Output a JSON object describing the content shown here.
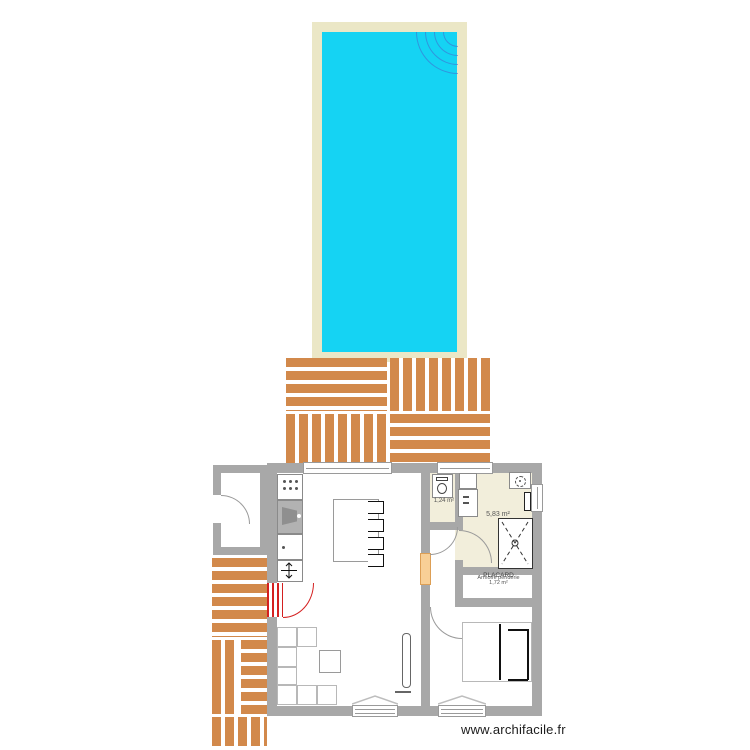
{
  "page": {
    "watermark": "www.archifacile.fr"
  },
  "rooms": {
    "wc": {
      "area_label": "1,24 m²"
    },
    "bathroom": {
      "area_label": "5,83 m²"
    },
    "placard": {
      "name": "PLACARD",
      "furniture_label": "Armoire penderie",
      "area_label": "1,72 m²"
    }
  },
  "colors": {
    "pool_water": "#15d3f3",
    "pool_margin": "#ebe7c6",
    "deck_wood": "#d2894b",
    "wall": "#a8a8a8",
    "room_fill_beige": "#f2eedb",
    "door_accent_red": "#d42020"
  }
}
